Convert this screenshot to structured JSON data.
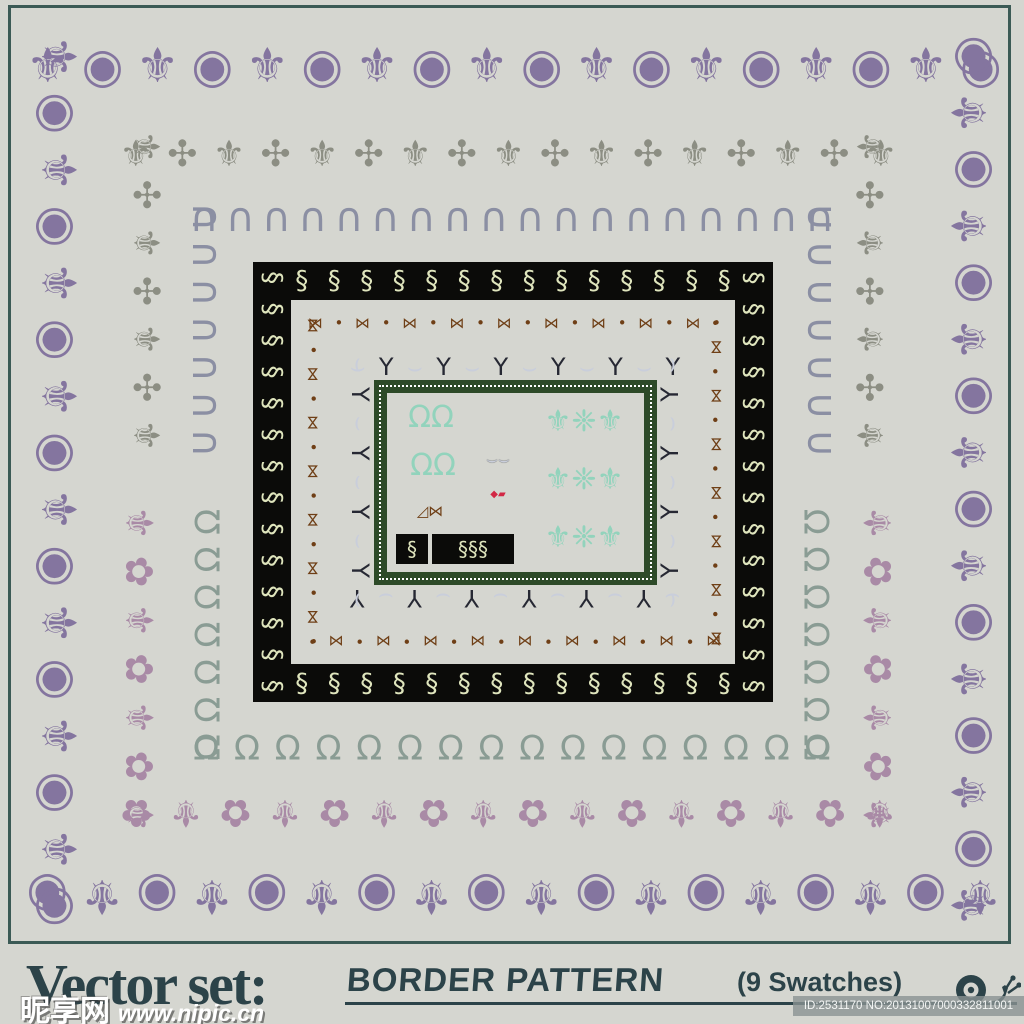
{
  "colors": {
    "background": "#d5d6d0",
    "frame": "#3b5a55",
    "caption_text": "#2c4349",
    "watermark_text": "#ffffff",
    "id_badge_bg": "rgba(138,146,146,0.8)",
    "id_badge_text": "#f4f6f5"
  },
  "caption": {
    "title": "Vector set:",
    "subtitle": "BORDER PATTERN",
    "swatch_count": "(9 Swatches)",
    "id_label": "ID:2531170 NO:20131007000332811001",
    "watermark_name": "昵享网",
    "watermark_url": "www.nipic.cn",
    "snail_icon": "snail-silhouette"
  },
  "rings": [
    {
      "name": "purple-fleur-meander",
      "shape": "full",
      "x": 20,
      "y": 28,
      "w": 988,
      "h": 906,
      "t": 76,
      "color": "#84759f",
      "font": 48,
      "unit": 56,
      "pattern": [
        {
          "ch": "⚜"
        },
        {
          "ch": "◉"
        }
      ]
    },
    {
      "name": "gray-fleur-scroll",
      "shape": "top",
      "x": 112,
      "y": 122,
      "w": 793,
      "t": 66,
      "sideEnd": 460,
      "color": "#8c8e83",
      "font": 36,
      "unit": 48,
      "pattern": [
        {
          "ch": "⚜"
        },
        {
          "ch": "✣"
        }
      ]
    },
    {
      "name": "slate-blue-scallop-arches",
      "shape": "top",
      "x": 186,
      "y": 198,
      "w": 652,
      "t": 40,
      "sideEnd": 462,
      "color": "#8b8fa3",
      "font": 40,
      "unit": 36,
      "pattern": [
        {
          "ch": "∩"
        }
      ]
    },
    {
      "name": "mauve-fleur-anchor",
      "shape": "bottom",
      "x": 112,
      "y": 498,
      "w": 793,
      "h": 342,
      "t": 54,
      "color": "#a98aa6",
      "font": 38,
      "unit": 50,
      "pattern": [
        {
          "ch": "⚜"
        },
        {
          "ch": "✿"
        }
      ]
    },
    {
      "name": "slate-green-circle-hoops",
      "shape": "bottom",
      "x": 186,
      "y": 503,
      "w": 652,
      "h": 263,
      "t": 40,
      "color": "#8a9c94",
      "font": 34,
      "unit": 40,
      "pattern": [
        {
          "ch": "℧"
        }
      ]
    },
    {
      "name": "cream-scroll-on-black",
      "shape": "full",
      "x": 253,
      "y": 262,
      "w": 520,
      "h": 440,
      "t": 38,
      "color": "#dfe5bd",
      "bg": "#0b0b09",
      "font": 26,
      "unit": 32,
      "pattern": [
        {
          "ch": "§"
        }
      ]
    },
    {
      "name": "brown-chain-knot",
      "shape": "full",
      "x": 302,
      "y": 312,
      "w": 425,
      "h": 340,
      "t": 22,
      "color": "#6f3f16",
      "font": 15,
      "unit": 24,
      "pattern": [
        {
          "ch": "⋈"
        },
        {
          "ch": "•"
        }
      ]
    },
    {
      "name": "lavender-swag-garland",
      "shape": "full",
      "x": 343,
      "y": 350,
      "w": 344,
      "h": 265,
      "t": 34,
      "color": "#c9cedb",
      "font": 24,
      "unit": 28,
      "pattern": [
        {
          "ch": "⌣",
          "color": "#c9cedb"
        },
        {
          "ch": "Y",
          "color": "#262833"
        }
      ]
    },
    {
      "name": "dark-green-dotted-frame",
      "shape": "solid",
      "x": 374,
      "y": 380,
      "w": 283,
      "h": 205,
      "t": 13,
      "color": "#2d4a28",
      "dot_color": "#ffffff"
    }
  ],
  "center_samples": [
    {
      "name": "teal-bud-pair-top",
      "x": 396,
      "y": 398,
      "w": 70,
      "h": 40,
      "text": "ΩΩ",
      "color": "#92d3bc",
      "size": 30
    },
    {
      "name": "teal-bud-pair-middle",
      "x": 398,
      "y": 446,
      "w": 70,
      "h": 40,
      "text": "ΩΩ",
      "color": "#92d3bc",
      "size": 30
    },
    {
      "name": "lavender-swag-unit",
      "x": 474,
      "y": 448,
      "w": 48,
      "h": 24,
      "text": "⌣⌣",
      "color": "#c9cedb",
      "size": 18,
      "shadow": "0 0 1px #1b1b22"
    },
    {
      "name": "red-accent-units",
      "x": 480,
      "y": 488,
      "w": 36,
      "h": 14,
      "text": "◆▰",
      "color": "#d22845",
      "size": 10
    },
    {
      "name": "brown-chain-units",
      "x": 398,
      "y": 500,
      "w": 64,
      "h": 22,
      "text": "◿⋈",
      "color": "#6f3f16",
      "size": 15
    },
    {
      "name": "cream-scroll-unit-small",
      "x": 396,
      "y": 534,
      "w": 32,
      "h": 30,
      "text": "§",
      "color": "#dfe5bd",
      "bg": "#0b0b09",
      "size": 20
    },
    {
      "name": "cream-scroll-unit-wide",
      "x": 432,
      "y": 534,
      "w": 82,
      "h": 30,
      "text": "§§§",
      "color": "#dfe5bd",
      "bg": "#0b0b09",
      "size": 20
    },
    {
      "name": "teal-corner-motif-1",
      "x": 524,
      "y": 396,
      "w": 120,
      "h": 52,
      "text": "⚜❈⚜",
      "color": "#92d3bc",
      "size": 30
    },
    {
      "name": "teal-corner-motif-2",
      "x": 524,
      "y": 454,
      "w": 120,
      "h": 52,
      "text": "⚜❈⚜",
      "color": "#92d3bc",
      "size": 30
    },
    {
      "name": "teal-corner-motif-3",
      "x": 524,
      "y": 512,
      "w": 120,
      "h": 52,
      "text": "⚜❈⚜",
      "color": "#92d3bc",
      "size": 30
    }
  ]
}
